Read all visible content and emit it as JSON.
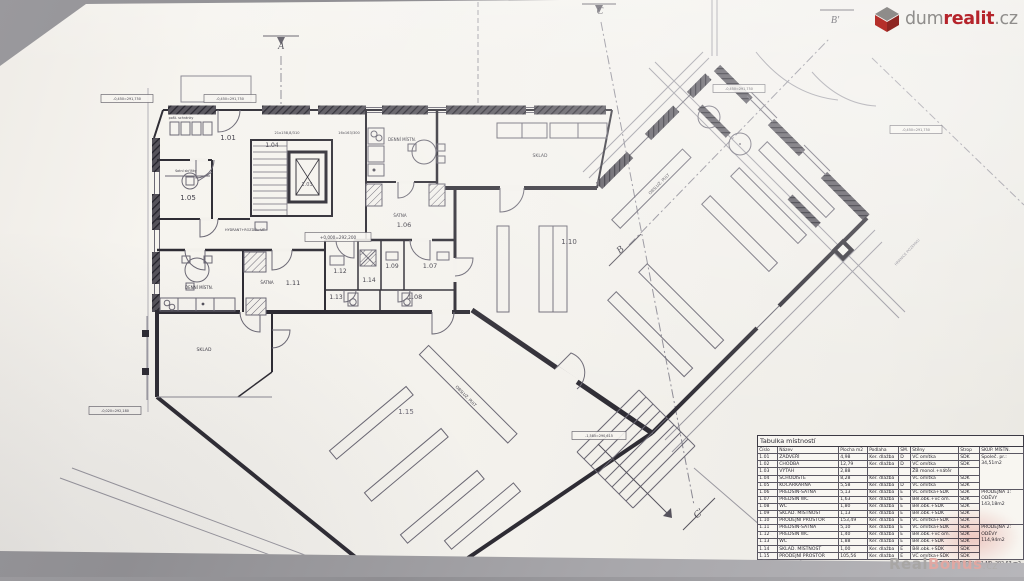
{
  "branding": {
    "logo_dum": "dum",
    "logo_realit": "realit",
    "logo_cz": ".cz",
    "watermark_real": "Real",
    "watermark_bonus": "Bonus",
    "watermark_cz": ".cz"
  },
  "colors": {
    "brand_red": "#b5242b",
    "logo_gray": "#8f8d8b",
    "ink_wall": "#2e2c34",
    "ink_line": "#6b6874",
    "paper": "#f3f1ec",
    "watermark_pink": "#e3a7a1"
  },
  "room_table": {
    "title": "Tabulka místností",
    "headers": [
      "Číslo",
      "Název",
      "Plocha m2",
      "Podlaha",
      "SM.",
      "Stěny",
      "Strop",
      "SKUP. MÍSTN."
    ],
    "rows": [
      [
        "1.01",
        "ZÁDVEŘÍ",
        "4,98",
        "Ker. dlažba",
        "D",
        "VC omítka",
        "SDK"
      ],
      [
        "1.02",
        "CHODBA",
        "12,79",
        "Ker. dlažba",
        "D",
        "VC omítka",
        "SDK"
      ],
      [
        "1.03",
        "VÝTAH",
        "2,88",
        "",
        "",
        "ŽB monol.+nátěr",
        ""
      ],
      [
        "1.04",
        "SCHODIŠTĚ",
        "8,28",
        "Ker. dlažba",
        "",
        "VC omítka",
        "SDK"
      ],
      [
        "1.05",
        "KOČÁRKÁRNA",
        "5,58",
        "Ker. dlažba",
        "D",
        "VC omítka",
        "SDK"
      ],
      [
        "1.06",
        "PŘEDSÍŇ-ŠATNA",
        "5,13",
        "Ker. dlažba",
        "E",
        "VC omítka+SDK",
        "SDK"
      ],
      [
        "1.07",
        "PŘEDSÍŇ WC",
        "1,63",
        "Ker. dlažba",
        "E",
        "Běl.obk.+vc om.",
        "SDK"
      ],
      [
        "1.08",
        "WC",
        "1,80",
        "Ker. dlažba",
        "E",
        "Běl.obk.+SDK",
        "SDK"
      ],
      [
        "1.09",
        "SKLAD. MÍSTNOST",
        "1,13",
        "Ker. dlažba",
        "E",
        "Běl.obk.+SDK",
        "SDK"
      ],
      [
        "1.10",
        "PRODEJNÍ PROSTOR",
        "153,49",
        "Ker. dlažba",
        "E",
        "VC omítka+SDK",
        "SDK"
      ],
      [
        "1.11",
        "PŘEDSÍŇ-ŠATNA",
        "5,10",
        "Ker. dlažba",
        "E",
        "VC omítka+SDK",
        "SDK"
      ],
      [
        "1.12",
        "PŘEDSÍŇ WC",
        "1,40",
        "Ker. dlažba",
        "E",
        "Běl.obk.+vc om.",
        "SDK"
      ],
      [
        "1.13",
        "WC",
        "1,88",
        "Ker. dlažba",
        "E",
        "Běl.obk.+SDK",
        "SDK"
      ],
      [
        "1.14",
        "SKLAD. MÍSTNOST",
        "1,00",
        "Ker. dlažba",
        "E",
        "Běl.obk.+SDK",
        "SDK"
      ],
      [
        "1.15",
        "PRODEJNÍ PROSTOR",
        "105,56",
        "Ker. dlažba",
        "E",
        "VC omítka+SDK",
        "SDK"
      ]
    ],
    "groups": [
      {
        "start": 0,
        "span": 5,
        "text": "Společ. pr.:\n34,51m2"
      },
      {
        "start": 5,
        "span": 5,
        "text": "PRODEJNA 1:\nODĚVY\n143,18m2"
      },
      {
        "start": 10,
        "span": 5,
        "text": "PRODEJNA 2:\nODĚVY\n114,94m2"
      }
    ],
    "total_label": "CELKEM PLOCHA 1.NP:",
    "total_value": "292,63 m2"
  },
  "plan_labels": [
    {
      "t": "1.01",
      "x": 228,
      "y": 140,
      "s": 7
    },
    {
      "t": "1.04",
      "x": 272,
      "y": 147,
      "s": 6
    },
    {
      "t": "1.03",
      "x": 307,
      "y": 186,
      "s": 5,
      "c": "#55525c"
    },
    {
      "t": "1.05",
      "x": 188,
      "y": 200,
      "s": 7
    },
    {
      "t": "DENNÍ MÍSTN.",
      "x": 402,
      "y": 141,
      "s": 4
    },
    {
      "t": "ŠATNA",
      "x": 400,
      "y": 217,
      "s": 4
    },
    {
      "t": "1.06",
      "x": 404,
      "y": 227,
      "s": 6.5
    },
    {
      "t": "SKLAD",
      "x": 540,
      "y": 157,
      "s": 4.5
    },
    {
      "t": "1.10",
      "x": 569,
      "y": 244,
      "s": 7
    },
    {
      "t": "DENNÍ MÍSTN.",
      "x": 199,
      "y": 289,
      "s": 4
    },
    {
      "t": "ŠATNA",
      "x": 267,
      "y": 284,
      "s": 4
    },
    {
      "t": "1.11",
      "x": 293,
      "y": 285,
      "s": 6.5
    },
    {
      "t": "1.12",
      "x": 340,
      "y": 273,
      "s": 6
    },
    {
      "t": "1.14",
      "x": 369,
      "y": 282,
      "s": 6
    },
    {
      "t": "1.09",
      "x": 392,
      "y": 268,
      "s": 6
    },
    {
      "t": "1.07",
      "x": 430,
      "y": 268,
      "s": 6.5
    },
    {
      "t": "1.13",
      "x": 336,
      "y": 299,
      "s": 6
    },
    {
      "t": "1.08",
      "x": 415,
      "y": 299,
      "s": 6.5
    },
    {
      "t": "SKLAD",
      "x": 204,
      "y": 351,
      "s": 4.5
    },
    {
      "t": "1.15",
      "x": 406,
      "y": 414,
      "s": 7,
      "c": "#6d6a76"
    },
    {
      "t": "OBSLUŽ. PULT",
      "x": 660,
      "y": 185,
      "s": 4,
      "r": -45
    },
    {
      "t": "OBSLUŽ. PULT",
      "x": 465,
      "y": 397,
      "s": 4,
      "r": 45
    },
    {
      "t": "pošt. schránky",
      "x": 181,
      "y": 119,
      "s": 3.4
    },
    {
      "t": "šatní skříňky",
      "x": 186,
      "y": 172,
      "s": 3.4
    },
    {
      "t": "21x158,8/310",
      "x": 287,
      "y": 134,
      "s": 3.6
    },
    {
      "t": "16x163/300",
      "x": 349,
      "y": 134,
      "s": 3.6
    },
    {
      "t": "HYDRANT+ROZDĚL. ÚT",
      "x": 245,
      "y": 231,
      "s": 3.4
    },
    {
      "t": "+0,000=292,200",
      "x": 338,
      "y": 239,
      "s": 4.2,
      "box": true,
      "w": 66,
      "h": 9
    },
    {
      "t": "-0,450=291,750",
      "x": 127,
      "y": 100,
      "s": 3.4,
      "box": true,
      "w": 52,
      "h": 8
    },
    {
      "t": "-0,450=291,750",
      "x": 230,
      "y": 100,
      "s": 3.4,
      "box": true,
      "w": 52,
      "h": 8
    },
    {
      "t": "-0,450=291,750",
      "x": 739,
      "y": 90,
      "s": 3.4,
      "box": true,
      "w": 52,
      "h": 8
    },
    {
      "t": "-0,450=291,750",
      "x": 916,
      "y": 131,
      "s": 3.4,
      "box": true,
      "w": 52,
      "h": 8
    },
    {
      "t": "-0,020=292,180",
      "x": 115,
      "y": 412,
      "s": 3.4,
      "box": true,
      "w": 52,
      "h": 8
    },
    {
      "t": "-1,585=290,615",
      "x": 599,
      "y": 437,
      "s": 3.4,
      "box": true,
      "w": 54,
      "h": 8
    },
    {
      "t": "A",
      "x": 281,
      "y": 49,
      "s": 10,
      "serif": true
    },
    {
      "t": "C",
      "x": 600,
      "y": 14,
      "s": 10,
      "serif": true
    },
    {
      "t": "B'",
      "x": 835,
      "y": 23,
      "s": 10,
      "serif": true
    },
    {
      "t": "B",
      "x": 622,
      "y": 252,
      "s": 10,
      "serif": true,
      "r": -40
    },
    {
      "t": "C'",
      "x": 700,
      "y": 516,
      "s": 10,
      "serif": true,
      "r": -40
    },
    {
      "t": "HRANICE POZEMKU",
      "x": 908,
      "y": 253,
      "s": 3.6,
      "r": -47,
      "c": "#8a8892"
    }
  ]
}
